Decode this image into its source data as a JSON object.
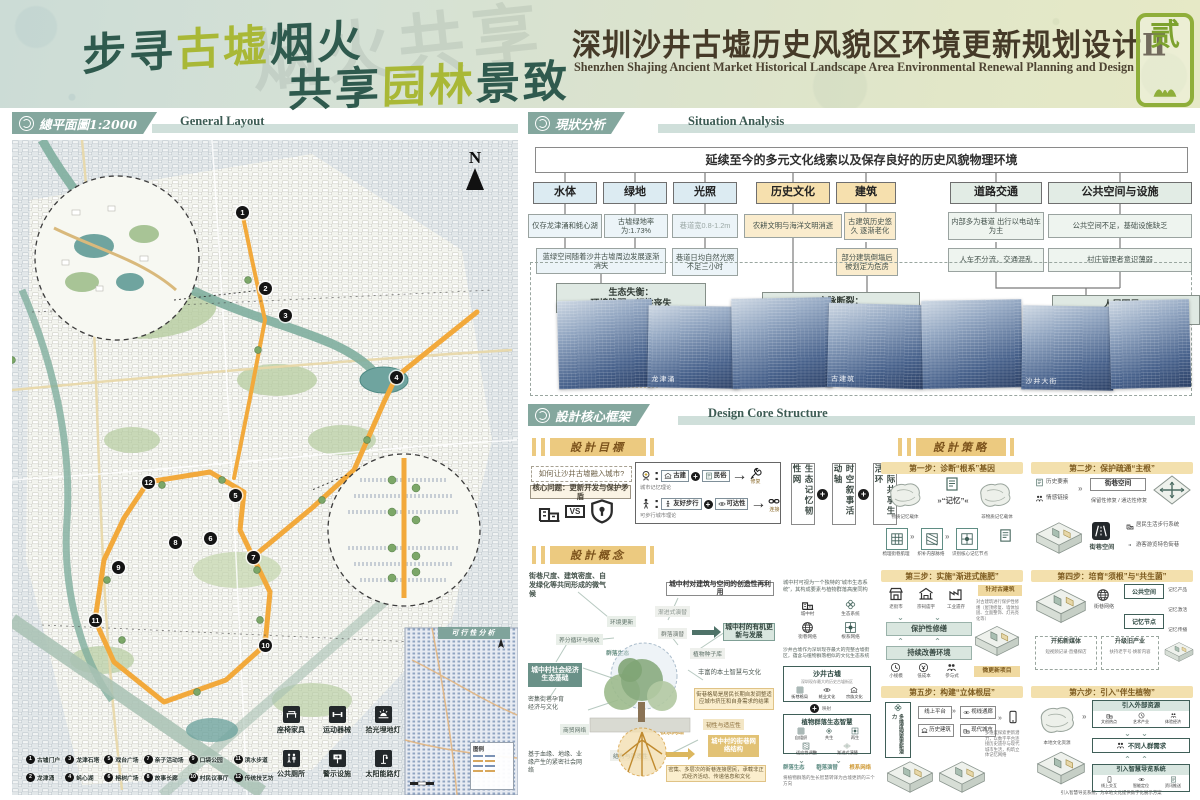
{
  "header": {
    "slogan1": {
      "a": "步寻",
      "b": "古墟",
      "c": "烟火"
    },
    "slogan2": {
      "a": "共享",
      "b": "园林",
      "c": "景致"
    },
    "ghost": "烟火共享",
    "title_cn": "深圳沙井古墟历史风貌区环境更新规划设计Ⅱ",
    "title_en": "Shenzhen Shajing Ancient Market Historical Landscape Area Environmental Renewal Planning and Design",
    "seal_char": "贰"
  },
  "colors": {
    "accent_teal": "#84a79e",
    "accent_gold": "#ecca80",
    "route_orange": "#f2a93b",
    "photo_navy": "#3d5a80",
    "olive": "#a9b836"
  },
  "layout": {
    "section_cn": "總平面圖1:2000",
    "section_en": "General Layout",
    "north": "N",
    "markers": [
      "1",
      "2",
      "3",
      "4",
      "5",
      "6",
      "7",
      "8",
      "9",
      "10",
      "11",
      "12"
    ],
    "legend": [
      {
        "n": "1",
        "t": "古墟门户"
      },
      {
        "n": "2",
        "t": "龙津涌"
      },
      {
        "n": "3",
        "t": "龙津石塔"
      },
      {
        "n": "4",
        "t": "蚝心湖"
      },
      {
        "n": "5",
        "t": "戏台广场"
      },
      {
        "n": "6",
        "t": "榕树广场"
      },
      {
        "n": "7",
        "t": "亲子活动场"
      },
      {
        "n": "8",
        "t": "故事长廊"
      },
      {
        "n": "9",
        "t": "口袋公园"
      },
      {
        "n": "10",
        "t": "村民议事厅"
      },
      {
        "n": "11",
        "t": "滨水步道"
      },
      {
        "n": "12",
        "t": "传统技艺坊"
      }
    ],
    "facilities": [
      "座椅家具",
      "运动器械",
      "拾光埋地灯",
      "公共厕所",
      "警示设施",
      "太阳能路灯"
    ],
    "inset_title": "可行性分析",
    "inset_legend": "图例"
  },
  "situation": {
    "section_cn": "現狀分析",
    "section_en": "Situation Analysis",
    "top_box": "延续至今的多元文化线索以及保存良好的历史风貌物理环境",
    "cats": [
      {
        "label": "水体",
        "sub1": "仅存龙津涌和蚝心湖"
      },
      {
        "label": "绿地",
        "sub1": "古墟绿地率为:1.73%"
      },
      {
        "label": "光照",
        "sub1": "巷道宽0.8-1.2m",
        "sub2": "巷道日均自然光照不足三小时"
      },
      {
        "label": "历史文化",
        "sub1": "农耕文明与海洋文明消逝"
      },
      {
        "label": "建筑",
        "sub1": "古建筑历史悠久 逐渐老化",
        "sub2": "部分建筑倒塌后被划定为危房"
      },
      {
        "label": "道路交通",
        "sub1": "内部多为巷道 出行以电动车为主",
        "sub2": "人车不分流，交通混乱"
      },
      {
        "label": "公共空间与设施",
        "sub1": "公共空间不足，基础设施缺乏",
        "sub2": "村庄管理者意识薄弱"
      }
    ],
    "merged_sub": "蓝绿空间随着沙井古墟周边发展逐渐消失",
    "conclusions": [
      {
        "a": "生态失衡：",
        "b": "环境脆弱，韧性丧失"
      },
      {
        "a": "文脉断裂：",
        "b": "遗产隐没，记忆消散"
      },
      {
        "a": "人居困局：",
        "b": "活力钝化，设施滞后"
      }
    ],
    "photo_caps": [
      "龙津涌",
      "古建筑",
      "沙井大街"
    ]
  },
  "design": {
    "section_cn": "設計核心框架",
    "section_en": "Design Core Structure",
    "goals": {
      "tab": "設計目標",
      "question": "如何让沙井古墟融入城市?",
      "core": "核心问题：更新开发与保护矛盾",
      "vs": "VS",
      "t1": "城市记忆理论",
      "t1a": "古建",
      "t1b": "民俗",
      "t1r": "修复",
      "t2": "可步行城市理论",
      "t2a": "友好步行",
      "t2b": "可达性",
      "t2r": "连接",
      "g1": "生态记忆韧性网",
      "g2": "时空叙事活动轴",
      "g3": "代际共享生活环"
    },
    "concept": {
      "tab": "設計概念",
      "micro": "街巷尺度、建筑密度、自发绿化等共同形成的微气候",
      "env": "环境更新",
      "nutrient": "养分循环与吸收",
      "community": "群落生态",
      "socio": "城中村社会经济生态基础",
      "dense": "密集街巷孕育经济与文化",
      "trade": "商贸网络",
      "social": "基于血缘、地缘、业缘产生的紧密社会网络",
      "creative": "城中村对建筑与空间的创造性再利用",
      "succ": "渐进式演替",
      "csucc": "群落演替",
      "organic": "城中村的有机更新与发展",
      "seed": "植物种子库",
      "wisdom": "丰富的本土智慧与文化",
      "pattern": "街巷格局是居民长期自发调整适应城市挤压和自身需求的结果",
      "resilience": "韧性与适应性",
      "root": "根系网络",
      "structure": "结构与渗透性",
      "street_structure": "城中村的街巷网络结构",
      "dense_desc": "密集、多层次的街巷连接居民，承载非正式经济活动、传递信息和文化",
      "side": {
        "intro": "城中村可视为一个独特的“城市生态系统”，其构成要素与植物群落高度同构",
        "d1": "城中村",
        "d2": "生态系统",
        "d3": "街巷网络",
        "d4": "根系网络",
        "note": "沙井古墟作为深圳现存最大的完整古墟街区，蕴含与植物群落相似的文化生态系统",
        "b1": "沙井古墟",
        "b1s": "深圳现存最大的历史古墟街区",
        "b1i": [
          "街巷格局",
          "蚝业文化",
          "宗族文化"
        ],
        "link": "映射",
        "b2": "植物群落生态智慧",
        "b2i": [
          "自组织",
          "共生",
          "再生",
          "适应性调整",
          "渐进式演替"
        ],
        "o1": "群落生态",
        "o2": "群落演替",
        "o3": "根系网络",
        "note2": "将植物群落的生长智慧转译为古墟更新的三个方向"
      }
    },
    "strategy": {
      "tab": "設計策略",
      "c1": {
        "title": "第一步：诊断“根系”基因",
        "l": "物质记忆载体",
        "m": "»“记忆”«",
        "r": "非物质记忆载体",
        "s1": "梳理街巷肌理",
        "s2": "织补内部脉络",
        "s3": "识别核心记忆节点"
      },
      "c2": {
        "title": "第二步：保护疏通“主根”",
        "i1": "历史要素",
        "i2": "情感链接",
        "sp": "街巷空间",
        "r1": "保留性修复",
        "r2": "通达性修复",
        "b1": "居民生活步行系统",
        "b2": "游客游览特色街巷",
        "sp2": "街巷空间"
      },
      "c3": {
        "title": "第三步：实施“渐进式施肥”",
        "i1": "老街市",
        "i2": "宗祠庙宇",
        "i3": "工业遗存",
        "band1": "保护性修缮",
        "band2": "持续改善环境",
        "nt": "针对古建筑",
        "note": "对古建筑进行保护性修缮（屋顶修复、墙体加固、立面整饰、灯光亮化等）",
        "t1": "小规模",
        "t2": "低成本",
        "t3": "参与式",
        "tag": "微更新项目"
      },
      "c4": {
        "title": "第四步：培育“须根”与“共生菌”",
        "net": "街巷网络",
        "p1": "公共空间",
        "p2": "记忆节点",
        "m1": "开拓新媒体",
        "m1s": "短视频记录·直播探店",
        "m2": "升级旧产业",
        "m2s": "扶持老字号·焕新内容",
        "o1": "记忆产品",
        "o2": "记忆激活",
        "o3": "记忆传播"
      },
      "c5": {
        "title": "第五步：构建“立体根层”",
        "box": "多维度探索更新潜力",
        "k1": "线上平台",
        "k2": "视线通廊",
        "k3": "历史建筑",
        "k4": "现代城市",
        "note": "多维度探索更新潜力，以数字平台连接历史遗存与现代城市生活，构筑立体记忆网络"
      },
      "c6": {
        "title": "第六步：引入“伴生植物”",
        "src": "本地文化资源",
        "b1": "引入外部资源",
        "b1a": "文创热点",
        "b1b": "艺术产业",
        "b1c": "体验经济",
        "b2": "不同人群需求",
        "b3": "引入智慧导览系统",
        "b3a": "线上交互",
        "b3b": "智能定位",
        "b3c": "资讯推送",
        "note": "引入智慧导览系统，为本地文化提供数字化展示方案"
      }
    }
  }
}
